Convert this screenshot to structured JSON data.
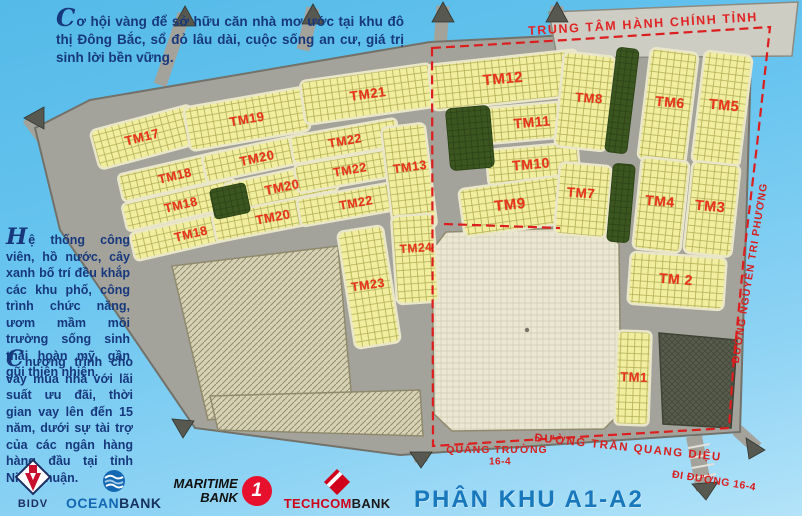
{
  "promo": {
    "p1": "Cơ hội vàng để sở hữu căn nhà mơ ước tại khu đô thị Đông Bắc, sổ đỏ lâu dài, cuộc sống an cư, giá trị sinh lời bền vững.",
    "p2": "Hệ thống công viên, hồ nước, cây xanh bố trí đều khắp các khu phố, công trình chức năng, ươm mầm môi trường sống sinh thái hoàn mỹ, gần gũi thiên nhiên.",
    "p3": "Chương trình cho vay mua nhà với lãi suất ưu đãi, thời gian vay lên đến 15 năm, dưới sự tài trợ của các ngân hàng hàng đầu tại tỉnh Ninh Thuận."
  },
  "map": {
    "admin_center_label": "TRUNG TÂM HÀNH CHÍNH TỈNH",
    "subdivision_title": "PHÂN KHU A1-A2",
    "streets": [
      {
        "name": "ĐƯỜNG NGUYỄN TRI PHƯƠNG",
        "x": 750,
        "y": 273,
        "rot": -81,
        "size": 10.5,
        "spacing": 1
      },
      {
        "name": "ĐƯỜNG TRẦN QUANG DIỆU",
        "x": 628,
        "y": 448,
        "rot": 6,
        "size": 11.5,
        "spacing": 1.5
      },
      {
        "name": "QUẢNG TRƯỜNG",
        "x": 497,
        "y": 450,
        "rot": 0,
        "size": 10.5,
        "spacing": 1
      },
      {
        "name": "16-4",
        "x": 500,
        "y": 462,
        "rot": 0,
        "size": 10,
        "spacing": 0.5
      },
      {
        "name": "ĐI ĐƯỜNG 16-4",
        "x": 714,
        "y": 481,
        "rot": 9,
        "size": 10.5,
        "spacing": 0.5
      }
    ],
    "blocks": [
      {
        "label": "TM17",
        "x": 142,
        "y": 137,
        "rot": -14,
        "size": 13
      },
      {
        "label": "TM19",
        "x": 247,
        "y": 119,
        "rot": -10,
        "size": 13
      },
      {
        "label": "TM21",
        "x": 368,
        "y": 94,
        "rot": -8,
        "size": 13.5
      },
      {
        "label": "TM18",
        "x": 175,
        "y": 176,
        "rot": -13,
        "size": 12.5
      },
      {
        "label": "TM18",
        "x": 181,
        "y": 205,
        "rot": -13,
        "size": 12.5
      },
      {
        "label": "TM18",
        "x": 191,
        "y": 234,
        "rot": -13,
        "size": 12.5
      },
      {
        "label": "TM20",
        "x": 257,
        "y": 158,
        "rot": -12,
        "size": 13
      },
      {
        "label": "TM20",
        "x": 282,
        "y": 187,
        "rot": -12,
        "size": 13
      },
      {
        "label": "TM20",
        "x": 273,
        "y": 217,
        "rot": -11,
        "size": 13
      },
      {
        "label": "TM22",
        "x": 345,
        "y": 141,
        "rot": -10,
        "size": 12.5
      },
      {
        "label": "TM22",
        "x": 350,
        "y": 170,
        "rot": -10,
        "size": 12.5
      },
      {
        "label": "TM22",
        "x": 356,
        "y": 203,
        "rot": -10,
        "size": 12.5
      },
      {
        "label": "TM13",
        "x": 410,
        "y": 167,
        "rot": -8,
        "size": 12.5
      },
      {
        "label": "TM24",
        "x": 416,
        "y": 248,
        "rot": -4,
        "size": 12
      },
      {
        "label": "TM23",
        "x": 368,
        "y": 285,
        "rot": -8,
        "size": 12.5
      },
      {
        "label": "TM12",
        "x": 503,
        "y": 79,
        "rot": -5,
        "size": 15
      },
      {
        "label": "TM11",
        "x": 532,
        "y": 122,
        "rot": -5,
        "size": 14
      },
      {
        "label": "TM10",
        "x": 531,
        "y": 164,
        "rot": -5,
        "size": 14
      },
      {
        "label": "TM9",
        "x": 510,
        "y": 205,
        "rot": -6,
        "size": 15
      },
      {
        "label": "TM8",
        "x": 589,
        "y": 98,
        "rot": 4,
        "size": 13
      },
      {
        "label": "TM7",
        "x": 581,
        "y": 193,
        "rot": 4,
        "size": 13.5
      },
      {
        "label": "TM6",
        "x": 670,
        "y": 102,
        "rot": 5,
        "size": 14
      },
      {
        "label": "TM5",
        "x": 724,
        "y": 106,
        "rot": 5,
        "size": 14.5
      },
      {
        "label": "TM4",
        "x": 660,
        "y": 201,
        "rot": 5,
        "size": 14
      },
      {
        "label": "TM3",
        "x": 710,
        "y": 207,
        "rot": 5,
        "size": 14.5
      },
      {
        "label": "TM 2",
        "x": 676,
        "y": 279,
        "rot": 4,
        "size": 14
      },
      {
        "label": "TM1",
        "x": 634,
        "y": 377,
        "rot": 2,
        "size": 13
      }
    ]
  },
  "banks": {
    "bidv": {
      "name": "BIDV"
    },
    "oceanbank": {
      "part1": "OCEAN",
      "part2": "BANK"
    },
    "maritime": {
      "line1": "MARITIME",
      "line2": "BANK",
      "badge": "1"
    },
    "techcombank": {
      "part1": "TECHCOM",
      "part2": "BANK"
    }
  },
  "colors": {
    "label_red": "#e8341a",
    "boundary_red": "#dc1e1e",
    "title_blue": "#1878bb",
    "promo_navy": "#17387c",
    "block_yellow": "#f1ee9f",
    "park_green": "#3c5620",
    "road_gray": "#a3a39b",
    "sky_blue": "#69c5ef"
  }
}
